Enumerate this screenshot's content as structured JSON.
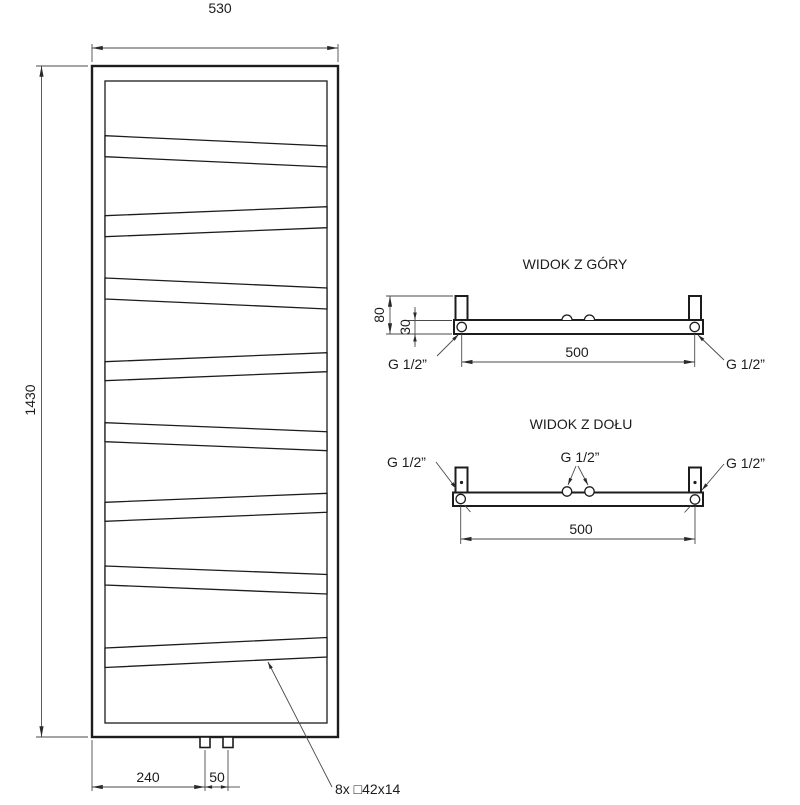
{
  "page": {
    "background": "#ffffff",
    "line_color": "#1c1c1c",
    "dim_color": "#4a4a4a"
  },
  "front_view": {
    "dims": {
      "width": "530",
      "height": "1430",
      "pipe_offset": "240",
      "pipe_spacing": "50"
    },
    "profile_note": "8x □42x14",
    "tube_count": 8
  },
  "top_view": {
    "title": "WIDOK Z GÓRY",
    "dims": {
      "depth": "80",
      "collector": "30",
      "connection_spacing": "500"
    },
    "labels": {
      "left_connection": "G 1/2”",
      "right_connection": "G 1/2”"
    }
  },
  "bottom_view": {
    "title": "WIDOK Z DOŁU",
    "dims": {
      "connection_spacing": "500"
    },
    "labels": {
      "left_connection": "G 1/2”",
      "center_connection": "G 1/2”",
      "right_connection": "G 1/2”"
    }
  }
}
